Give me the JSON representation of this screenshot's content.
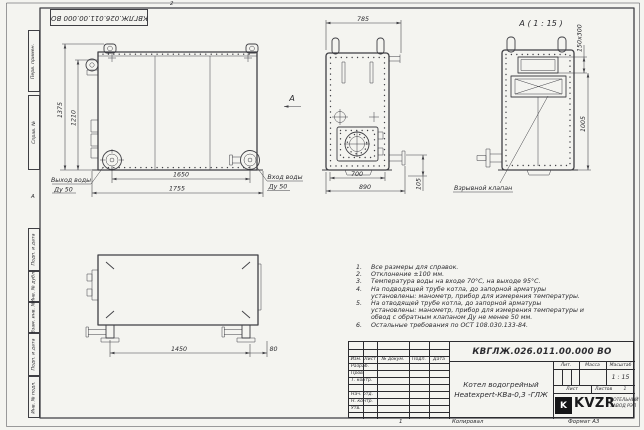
{
  "frame": {
    "stamp": "КВГЛЖ.026.011.00.000 ВО",
    "zone_top": "2",
    "zone_left": "А",
    "margin": [
      "Перв. примен.",
      "Справ. №",
      "Подп. и дата",
      "Инв. № дубл.",
      "Взам. инв. №",
      "Подп. и дата",
      "Инв. № подл."
    ]
  },
  "views": {
    "front": {
      "dim_v1": "1375",
      "dim_v2": "1210",
      "dim_h1": "1650",
      "dim_h2": "1755",
      "outlet1": "Выход воды",
      "outlet2": "Ду 50",
      "inlet1": "Вход воды",
      "inlet2": "Ду 50",
      "arrow": "А"
    },
    "side": {
      "dim_top": "785",
      "dim_b1": "700",
      "dim_b2": "890",
      "dim_pipe": "105",
      "valve": "Взрывной клапан"
    },
    "detail": {
      "title": "А ( 1 : 15 )",
      "dim_opening": "150х300",
      "dim_height": "1005"
    },
    "plan": {
      "dim1": "1450",
      "dim2": "80"
    }
  },
  "notes": {
    "items": [
      {
        "num": "1.",
        "text": "Все размеры для справок."
      },
      {
        "num": "2.",
        "text": "Отклонение ±100 мм."
      },
      {
        "num": "3.",
        "text": "Температура воды на входе 70°С, на выходе 95°С."
      },
      {
        "num": "4.",
        "text": "На подводящей трубе котла, до запорной арматуры установлены: манометр, прибор для измерения температуры."
      },
      {
        "num": "5.",
        "text": "На отводящей трубе котла, до запорной арматуры установлены: манометр, прибор для измерения температуры и обвод с обратным клапаном Ду не менее 50 мм."
      },
      {
        "num": "6.",
        "text": "Остальные требования по ОСТ 108.030.133-84."
      }
    ]
  },
  "title_block": {
    "designation": "КВГЛЖ.026.011.00.000 ВО",
    "product_line1": "Котел водогрейный",
    "product_line2": "Heatexpert-КВа-0,3 -ГЛЖ",
    "col_izm": "Изм.",
    "col_list": "Лист",
    "col_doc": "№ докум.",
    "col_sign": "Подп.",
    "col_date": "Дата",
    "row_razrab": "Разраб.",
    "row_prov": "Пров.",
    "row_tkontr": "Т. контр.",
    "row_nachotd": "Нач. отд.",
    "row_nkontr": "Н. контр.",
    "row_utv": "Утв.",
    "lit_label": "Лит.",
    "mass_label": "Масса",
    "scale_label": "Масштаб",
    "scale_value": "1 : 15",
    "sheet_label": "Лист",
    "sheets_label": "Листов",
    "sheets_value": "1",
    "logo_letter": "K",
    "logo_text": "KVZR",
    "company_line1": "КОТЕЛЬНЫЙ",
    "company_line2": "ЗАВОД РЭП",
    "footer_num": "1",
    "footer_copy": "Копировал",
    "footer_format": "Формат А3"
  },
  "colors": {
    "line": "#3f3f44",
    "paper": "#f4f4f0",
    "logo": "#151517"
  }
}
